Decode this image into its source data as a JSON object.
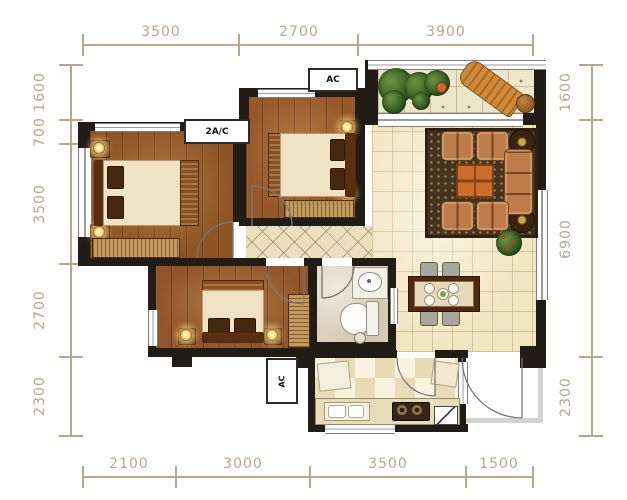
{
  "dimensions": {
    "top": [
      "3500",
      "2700",
      "3900"
    ],
    "bottom": [
      "2100",
      "3000",
      "3500",
      "1500"
    ],
    "left": [
      "1600",
      "700",
      "3500",
      "2700",
      "2300"
    ],
    "right": [
      "1600",
      "6900",
      "2300"
    ]
  },
  "labels": {
    "ac_top": "AC",
    "ac_master": "2A/C",
    "ac_small_bedroom": "AC"
  },
  "colors": {
    "dimension": "#b7a88c",
    "wall": "#211c16",
    "wood_floor": "#8e5424",
    "living_tile": "#f2e6c2",
    "balcony_tile": "#eee6c8",
    "rug": "#44341f",
    "sofa": "#bd7c4a",
    "coffee_table": "#cb6c2c",
    "plant_green": "#3c6b2c",
    "counter": "#e8dcba"
  }
}
